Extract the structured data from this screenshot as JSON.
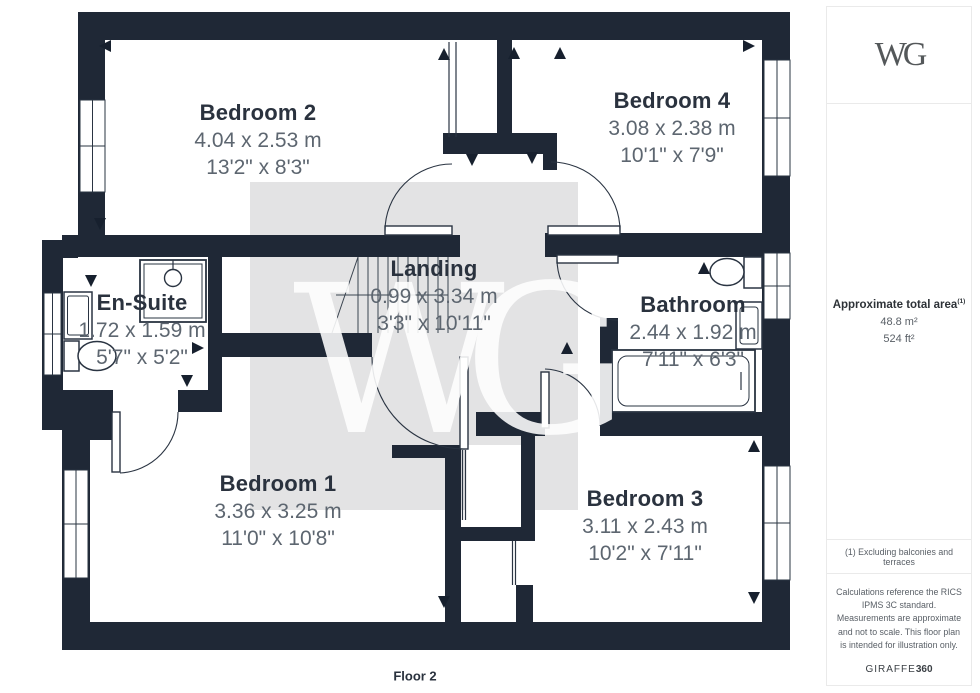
{
  "plan": {
    "floor_label": "Floor 2",
    "watermark": "WG",
    "rooms": [
      {
        "name": "Bedroom 2",
        "metric": "4.04 x 2.53 m",
        "imperial": "13'2\" x 8'3\""
      },
      {
        "name": "Bedroom 4",
        "metric": "3.08 x 2.38 m",
        "imperial": "10'1\" x 7'9\""
      },
      {
        "name": "En-Suite",
        "metric": "1.72 x 1.59 m",
        "imperial": "5'7\" x 5'2\""
      },
      {
        "name": "Landing",
        "metric": "0.99 x 3.34 m",
        "imperial": "3'3\" x 10'11\""
      },
      {
        "name": "Bathroom",
        "metric": "2.44 x 1.92 m",
        "imperial": "7'11\" x 6'3\""
      },
      {
        "name": "Bedroom 1",
        "metric": "3.36 x 3.25 m",
        "imperial": "11'0\" x 10'8\""
      },
      {
        "name": "Bedroom 3",
        "metric": "3.11 x 2.43 m",
        "imperial": "10'2\" x 7'11\""
      }
    ],
    "colors": {
      "wall": "#1f2836",
      "watermark_square": "#e3e3e4",
      "room_name_text": "#2a323e",
      "dimension_text": "#5d6670"
    }
  },
  "sidebar": {
    "logo": "WG",
    "area_title": "Approximate total area",
    "area_footnote_ref": "(1)",
    "area_m2": "48.8 m²",
    "area_ft2": "524 ft²",
    "footnote": "(1) Excluding balconies and terraces",
    "disclaimer": "Calculations reference the RICS IPMS 3C standard. Measurements are approximate and not to scale. This floor plan is intended for illustration only.",
    "brand": "GIRAFFE",
    "brand_suffix": "360"
  }
}
